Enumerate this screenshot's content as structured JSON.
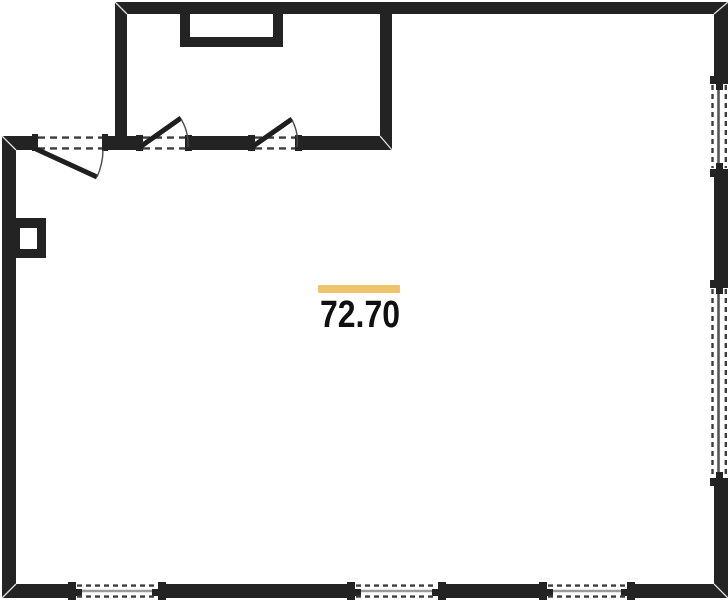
{
  "floorplan": {
    "area_value": "72.70",
    "accent_color": "#f0c46c",
    "wall_color": "#232323",
    "background_color": "#ffffff",
    "features": {
      "rooms": [
        "main-room",
        "upper-room"
      ],
      "doors": [
        "entrance-door",
        "upper-room-door-left",
        "upper-room-door-right"
      ],
      "windows": [
        "right-wall-window-1",
        "right-wall-window-2",
        "bottom-wall-window-1",
        "bottom-wall-window-2",
        "bottom-wall-window-3"
      ],
      "fixtures": [
        "top-wall-niche",
        "left-wall-shaft"
      ]
    }
  }
}
